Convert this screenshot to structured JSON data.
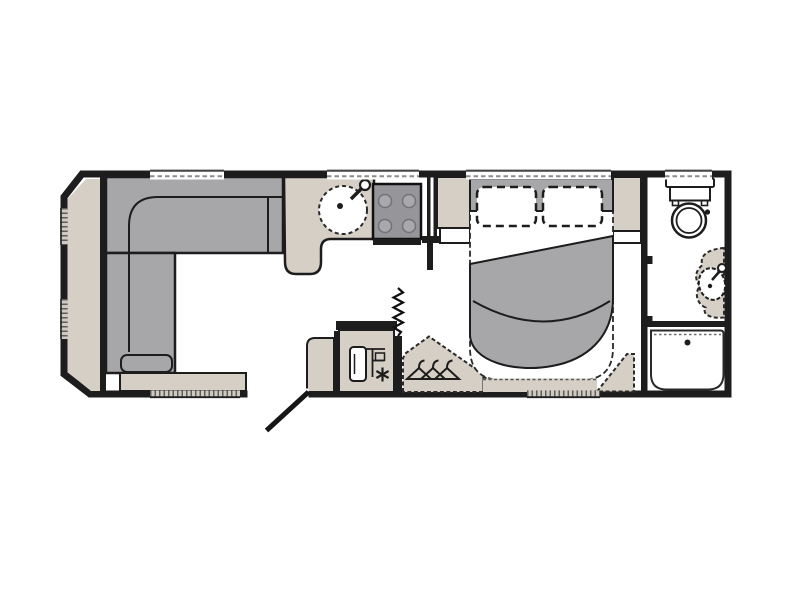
{
  "plan": {
    "type": "caravan-floor-plan",
    "background": "#ffffff",
    "colors": {
      "wall": "#1d1d1d",
      "beige": "#d6cfc5",
      "gray": "#a7a7aa",
      "hob": "#95959a",
      "burner": "#a9a9ad",
      "window_band": "#cfc9c0",
      "window_tick": "#5e5e5e",
      "white": "#ffffff"
    },
    "regions": [
      {
        "id": "lounge",
        "label": "Front lounge - L-shaped sofa with front chest seat"
      },
      {
        "id": "kitchen",
        "label": "Kitchen - round sink with tap and four-burner hob"
      },
      {
        "id": "entrance",
        "label": "Entrance door shown swung open"
      },
      {
        "id": "midships",
        "label": "Fridge cabinet, concertina door and wardrobe with coat hangers"
      },
      {
        "id": "bedroom",
        "label": "Bedroom - island bed with two pillows and turned-back duvet"
      },
      {
        "id": "bathroom",
        "label": "End washroom - toilet, wash basin and shower tray"
      }
    ],
    "fixtures": [
      "l-shaped-sofa",
      "front-chest",
      "front-window-shelf",
      "kitchen-worktop",
      "round-sink",
      "tap",
      "four-burner-hob",
      "fridge",
      "concertina-door",
      "wardrobe",
      "coat-hangers",
      "island-bed",
      "pillows",
      "duvet",
      "bedside-cabinets",
      "toilet",
      "wash-basin",
      "shower-tray",
      "entry-door"
    ],
    "window_count": 8
  }
}
